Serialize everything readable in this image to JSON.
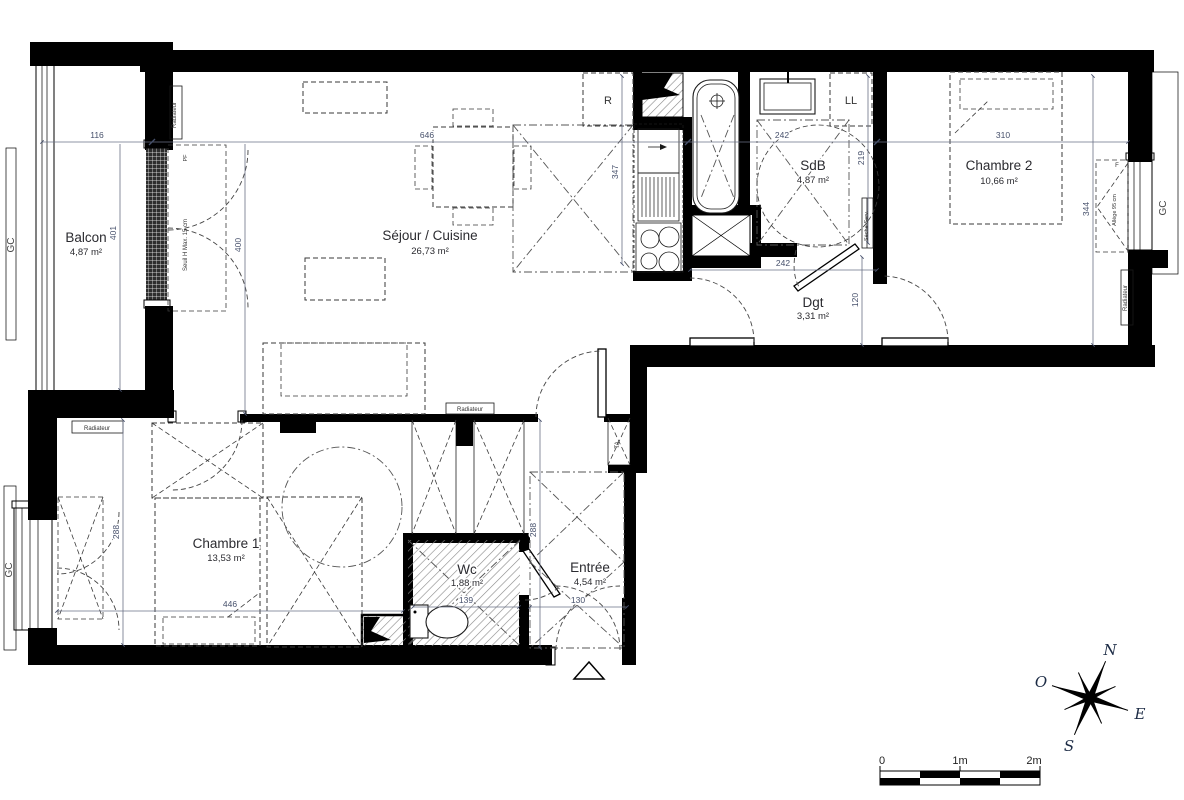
{
  "plan": {
    "rooms": {
      "balcon": {
        "name": "Balcon",
        "area": "4,87 m²"
      },
      "sejour_cuisine": {
        "name": "Séjour / Cuisine",
        "area": "26,73 m²"
      },
      "sdb": {
        "name": "SdB",
        "area": "4,87 m²"
      },
      "chambre2": {
        "name": "Chambre 2",
        "area": "10,66 m²"
      },
      "dgt": {
        "name": "Dgt",
        "area": "3,31 m²"
      },
      "chambre1": {
        "name": "Chambre 1",
        "area": "13,53 m²"
      },
      "wc": {
        "name": "Wc",
        "area": "1,88 m²"
      },
      "entree": {
        "name": "Entrée",
        "area": "4,54 m²"
      }
    },
    "dimensions": {
      "balcon_width": "116",
      "balcon_height": "401",
      "sejour_width": "646",
      "sejour_height": "400",
      "cuisine_height": "347",
      "sdb_width": "242",
      "sdb_height": "219",
      "chambre2_width": "310",
      "chambre2_height": "344",
      "dgt_width": "242",
      "dgt_height": "120",
      "chambre1_width": "446",
      "chambre1_height": "288",
      "entree_height": "288",
      "wc_width": "139",
      "entree_width": "130"
    },
    "annotations": {
      "gc": "GC",
      "radiateur": "Radiateur",
      "fridge": "R",
      "lave_linge": "LL",
      "ta": "TA",
      "seuil": "Seuil H Max. 15 cm",
      "allege": "Allège 95 cm",
      "seche_serviettes": "Sèche-Serv.",
      "porte_fenetre": "PF",
      "fenetre": "F"
    },
    "compass": {
      "north": "N",
      "west": "O",
      "east": "E",
      "south": "S"
    },
    "scale_bar": {
      "start": "0",
      "middle": "1m",
      "end": "2m"
    },
    "colors": {
      "wall": "#000000",
      "dim_text": "#46506b",
      "label_text": "#2b2b30",
      "background": "#ffffff"
    }
  }
}
